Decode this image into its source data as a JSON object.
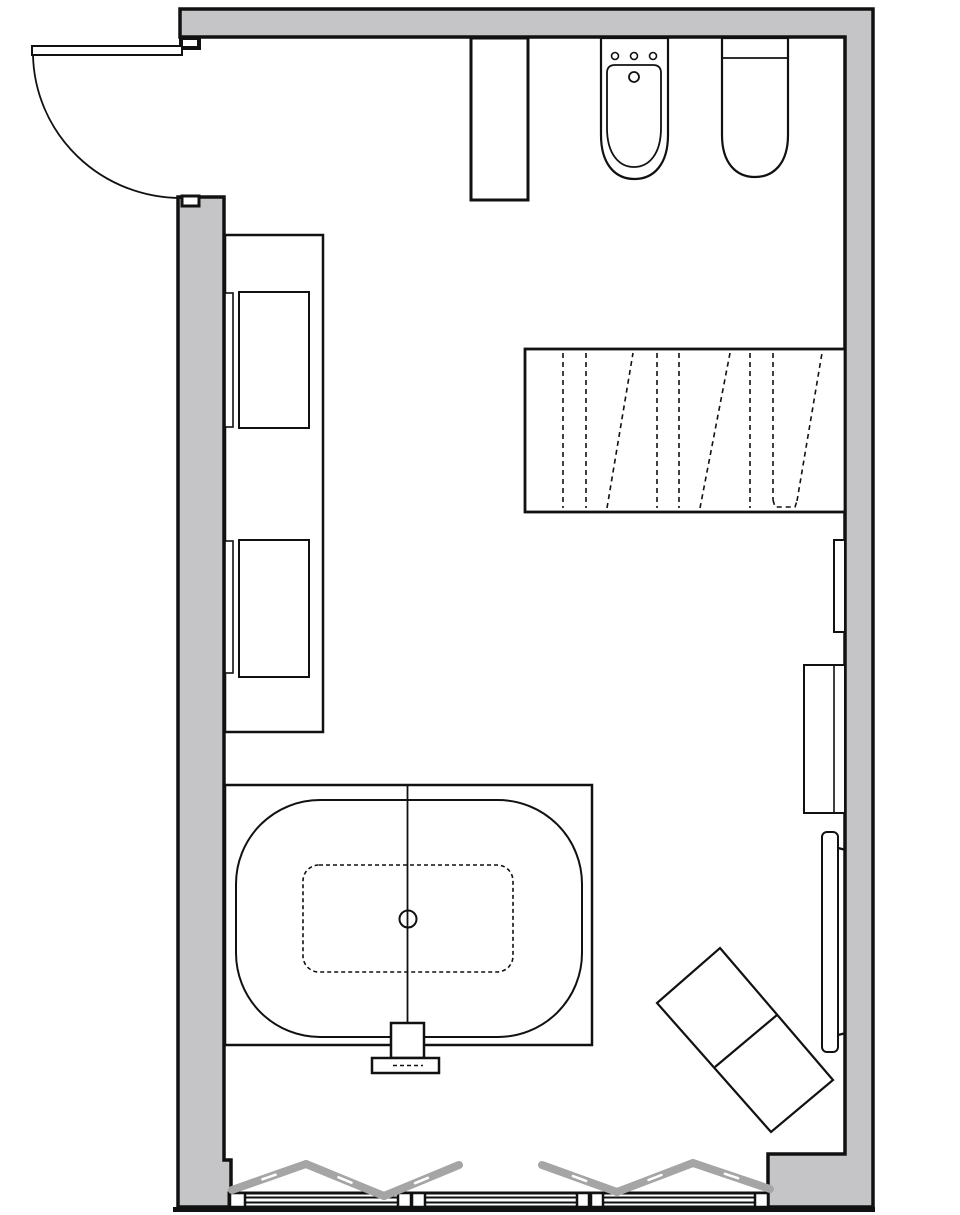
{
  "colors": {
    "background": "#ffffff",
    "wall_fill": "#c5c5c8",
    "line": "#111111",
    "fixture_fill": "#ffffff",
    "fold_panel": "#a5a5a5"
  },
  "plan": {
    "symbols": [
      "entry-door-swing",
      "partition-duct",
      "bidet",
      "toilet",
      "storage-cabinet",
      "radiator-dashed",
      "wall-shelf",
      "wall-cabinet",
      "heated-towel-panel",
      "bathtub-deck",
      "bathtub",
      "bath-faucet",
      "bench-rotated",
      "bifold-window-panels",
      "window-sill-glazing"
    ]
  }
}
